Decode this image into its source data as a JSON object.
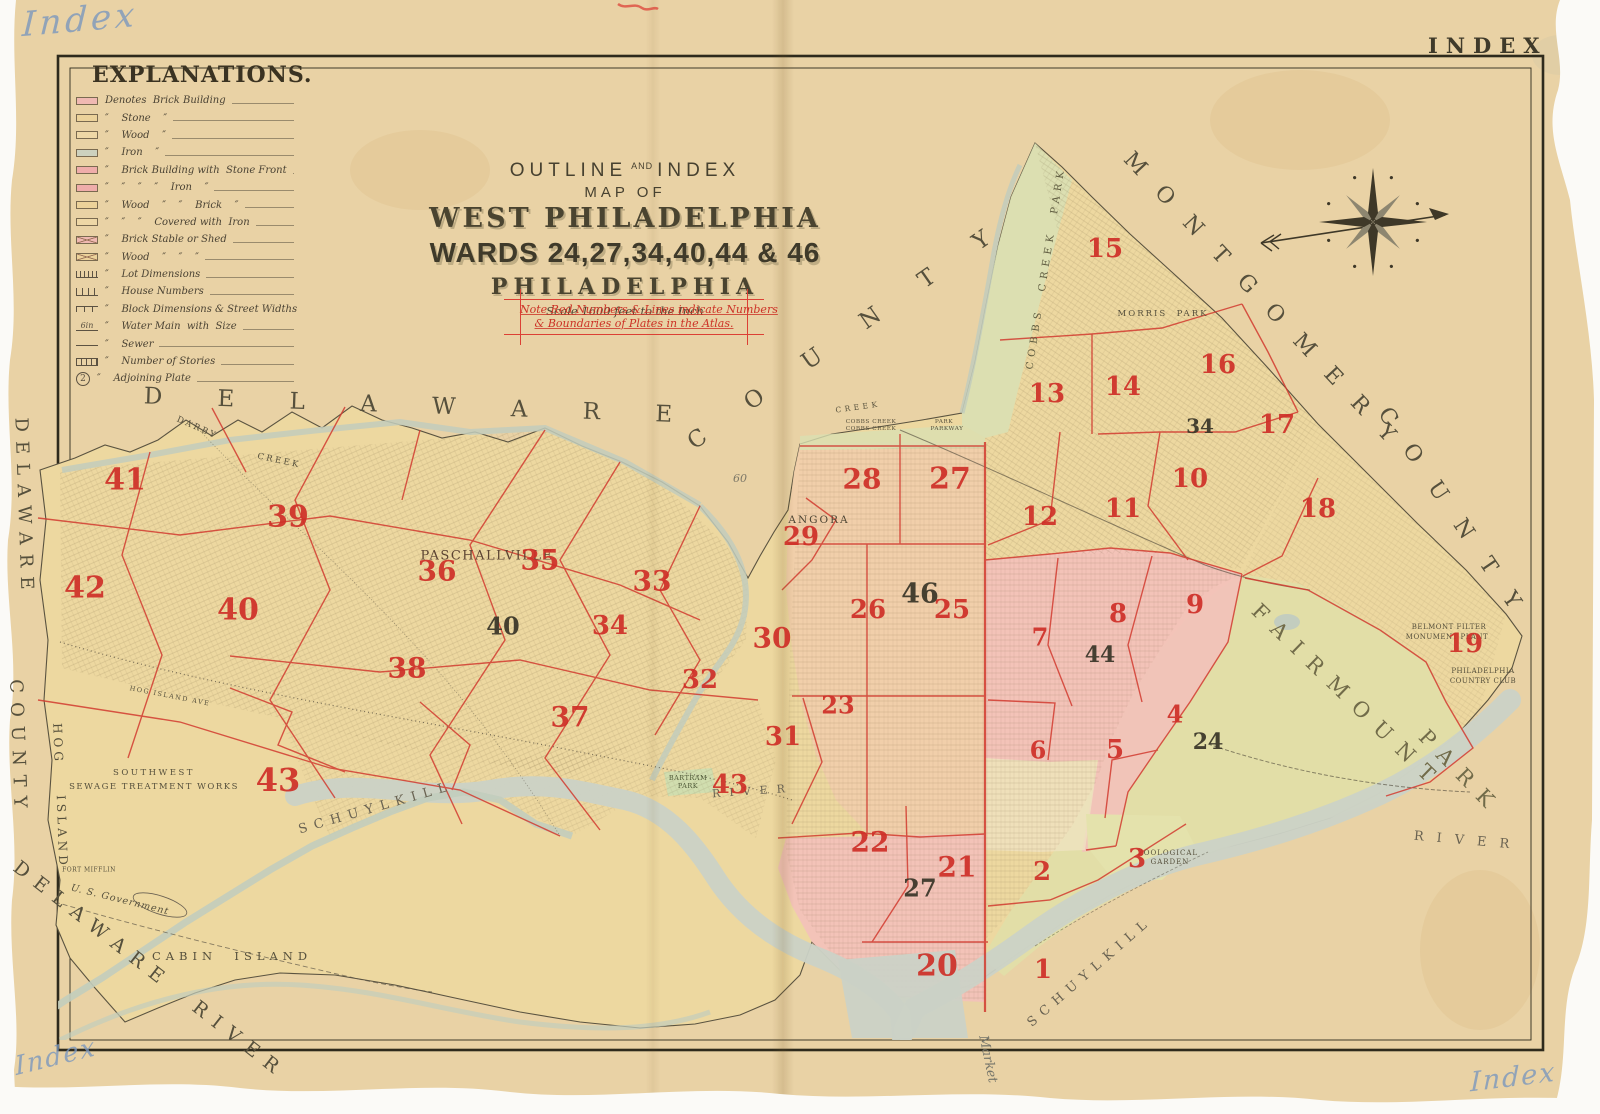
{
  "page": {
    "corner_label": "INDEX",
    "annotations": {
      "top_left": "Index",
      "bottom_left": "Index",
      "bottom_right": "Index",
      "market_note": "Market",
      "pencil_60": "60"
    }
  },
  "legend": {
    "title": "EXPLANATIONS.",
    "items": [
      {
        "swatch": "pink",
        "label": "Denotes  Brick Building"
      },
      {
        "swatch": "tan",
        "label": "″    Stone    ″"
      },
      {
        "swatch": "tan2",
        "label": "″    Wood    ″"
      },
      {
        "swatch": "iron",
        "label": "″    Iron    ″"
      },
      {
        "swatch": "pink2",
        "label": "″    Brick Building with  Stone Front"
      },
      {
        "swatch": "pink2",
        "label": "″    ″    ″    ″    Iron    ″"
      },
      {
        "swatch": "tan",
        "label": "″    Wood    ″    ″    Brick    ″"
      },
      {
        "swatch": "tan2",
        "label": "″    ″    ″    Covered with  Iron"
      },
      {
        "swatch": "xpink",
        "label": "″    Brick Stable or Shed"
      },
      {
        "swatch": "xtan",
        "label": "″    Wood    ″    ″    ″"
      },
      {
        "swatch": "lot",
        "label": "″    Lot Dimensions"
      },
      {
        "swatch": "house",
        "label": "″    House Numbers"
      },
      {
        "swatch": "block",
        "label": "″    Block Dimensions & Street Widths"
      },
      {
        "swatch": "wmain",
        "glyph": "6in",
        "label": "″    Water Main  with  Size"
      },
      {
        "swatch": "sewer",
        "label": "″    Sewer"
      },
      {
        "swatch": "stories",
        "label": "″    Number of Stories"
      },
      {
        "swatch": "circle",
        "glyph": "2",
        "label": "″    Adjoining Plate"
      }
    ]
  },
  "title_block": {
    "line1_left": "OUTLINE",
    "line1_mid": "AND",
    "line1_right": "INDEX",
    "line2": "MAP OF",
    "line3": "WEST PHILADELPHIA",
    "line4": "WARDS 24,27,34,40,44 & 46",
    "line5": "PHILADELPHIA",
    "scale": "Scale 1600 feet to the Inch",
    "note_line1": "Note Red Numbers & Lines indicate Numbers",
    "note_line2": "& Boundaries of Plates in the Atlas."
  },
  "map": {
    "plate_numbers": [
      {
        "n": "41",
        "x": 125,
        "y": 480,
        "s": 30
      },
      {
        "n": "39",
        "x": 288,
        "y": 517,
        "s": 30
      },
      {
        "n": "42",
        "x": 85,
        "y": 588,
        "s": 30
      },
      {
        "n": "40",
        "x": 238,
        "y": 610,
        "s": 30
      },
      {
        "n": "38",
        "x": 407,
        "y": 668,
        "s": 28
      },
      {
        "n": "36",
        "x": 437,
        "y": 571,
        "s": 28
      },
      {
        "n": "35",
        "x": 540,
        "y": 560,
        "s": 28
      },
      {
        "n": "33",
        "x": 652,
        "y": 581,
        "s": 28
      },
      {
        "n": "34",
        "x": 610,
        "y": 626,
        "s": 26
      },
      {
        "n": "30",
        "x": 772,
        "y": 638,
        "s": 28
      },
      {
        "n": "32",
        "x": 700,
        "y": 680,
        "s": 26
      },
      {
        "n": "37",
        "x": 570,
        "y": 717,
        "s": 28
      },
      {
        "n": "31",
        "x": 783,
        "y": 737,
        "s": 26
      },
      {
        "n": "43",
        "x": 730,
        "y": 785,
        "s": 26
      },
      {
        "n": "43",
        "x": 278,
        "y": 780,
        "s": 32
      },
      {
        "n": "23",
        "x": 838,
        "y": 705,
        "s": 24
      },
      {
        "n": "28",
        "x": 862,
        "y": 479,
        "s": 28
      },
      {
        "n": "27",
        "x": 950,
        "y": 479,
        "s": 30
      },
      {
        "n": "29",
        "x": 801,
        "y": 537,
        "s": 26
      },
      {
        "n": "26",
        "x": 868,
        "y": 610,
        "s": 26
      },
      {
        "n": "25",
        "x": 952,
        "y": 610,
        "s": 26
      },
      {
        "n": "12",
        "x": 1040,
        "y": 517,
        "s": 26
      },
      {
        "n": "7",
        "x": 1040,
        "y": 637,
        "s": 24
      },
      {
        "n": "8",
        "x": 1118,
        "y": 614,
        "s": 26
      },
      {
        "n": "9",
        "x": 1195,
        "y": 605,
        "s": 26
      },
      {
        "n": "4",
        "x": 1175,
        "y": 714,
        "s": 24
      },
      {
        "n": "6",
        "x": 1038,
        "y": 750,
        "s": 24
      },
      {
        "n": "5",
        "x": 1115,
        "y": 750,
        "s": 26
      },
      {
        "n": "19",
        "x": 1465,
        "y": 644,
        "s": 26
      },
      {
        "n": "15",
        "x": 1105,
        "y": 249,
        "s": 26
      },
      {
        "n": "16",
        "x": 1218,
        "y": 365,
        "s": 26
      },
      {
        "n": "13",
        "x": 1047,
        "y": 394,
        "s": 26
      },
      {
        "n": "14",
        "x": 1123,
        "y": 387,
        "s": 26
      },
      {
        "n": "17",
        "x": 1277,
        "y": 425,
        "s": 26
      },
      {
        "n": "10",
        "x": 1190,
        "y": 479,
        "s": 26
      },
      {
        "n": "11",
        "x": 1123,
        "y": 509,
        "s": 26
      },
      {
        "n": "18",
        "x": 1318,
        "y": 509,
        "s": 26
      },
      {
        "n": "22",
        "x": 870,
        "y": 842,
        "s": 28
      },
      {
        "n": "21",
        "x": 957,
        "y": 867,
        "s": 28
      },
      {
        "n": "2",
        "x": 1042,
        "y": 872,
        "s": 26
      },
      {
        "n": "3",
        "x": 1137,
        "y": 859,
        "s": 26
      },
      {
        "n": "20",
        "x": 937,
        "y": 966,
        "s": 30
      },
      {
        "n": "1",
        "x": 1043,
        "y": 970,
        "s": 26
      }
    ],
    "ward_numbers": [
      {
        "n": "46",
        "x": 920,
        "y": 594,
        "s": 27
      },
      {
        "n": "40",
        "x": 503,
        "y": 626,
        "s": 24
      },
      {
        "n": "27",
        "x": 920,
        "y": 888,
        "s": 24
      },
      {
        "n": "44",
        "x": 1100,
        "y": 655,
        "s": 22
      },
      {
        "n": "24",
        "x": 1208,
        "y": 742,
        "s": 22
      },
      {
        "n": "34",
        "x": 1200,
        "y": 426,
        "s": 20
      }
    ],
    "labels": [
      {
        "t": "D E L A W A R E",
        "x": 420,
        "y": 406,
        "r": 2,
        "s": 23,
        "ls": 24
      },
      {
        "t": "C O U N T Y",
        "x": 848,
        "y": 334,
        "r": -35,
        "s": 23,
        "ls": 22
      },
      {
        "t": "M O N T G O M E R Y",
        "x": 1262,
        "y": 300,
        "r": 47,
        "s": 22,
        "ls": 8
      },
      {
        "t": "C O U N T Y",
        "x": 1452,
        "y": 512,
        "r": 56,
        "s": 22,
        "ls": 10
      },
      {
        "t": "DELAWARE",
        "x": 24,
        "y": 508,
        "r": 88,
        "s": 18,
        "ls": 9
      },
      {
        "t": "COUNTY",
        "x": 18,
        "y": 748,
        "r": 88,
        "s": 18,
        "ls": 9
      },
      {
        "t": "HOG",
        "x": 58,
        "y": 744,
        "r": 88,
        "s": 12,
        "ls": 4
      },
      {
        "t": "ISLAND",
        "x": 62,
        "y": 832,
        "r": 88,
        "s": 12,
        "ls": 4
      },
      {
        "t": "DELAWARE  RIVER",
        "x": 150,
        "y": 970,
        "r": 38,
        "s": 19,
        "ls": 10
      },
      {
        "t": "SCHUYLKILL",
        "x": 376,
        "y": 808,
        "r": -16,
        "s": 13,
        "ls": 7,
        "c": "#6a6352"
      },
      {
        "t": "RIVER",
        "x": 753,
        "y": 791,
        "r": -4,
        "s": 11,
        "ls": 9,
        "c": "#6a6352"
      },
      {
        "t": "SCHUYLKILL",
        "x": 1090,
        "y": 972,
        "r": -41,
        "s": 13,
        "ls": 7,
        "c": "#6a6352"
      },
      {
        "t": "RIVER",
        "x": 1468,
        "y": 841,
        "r": 5,
        "s": 13,
        "ls": 13,
        "c": "#6a6352"
      },
      {
        "t": "FAIRMOUNT",
        "x": 1348,
        "y": 697,
        "r": 44,
        "s": 21,
        "ls": 13,
        "c": "#716b49"
      },
      {
        "t": "PARK",
        "x": 1461,
        "y": 773,
        "r": 46,
        "s": 21,
        "ls": 13,
        "c": "#716b49"
      },
      {
        "t": "COBBS  CREEK  PARK",
        "x": 1046,
        "y": 268,
        "r": -81,
        "s": 10,
        "ls": 5,
        "c": "#5f5c40"
      },
      {
        "t": "MORRIS  PARK",
        "x": 1163,
        "y": 314,
        "r": 0,
        "s": 8.5,
        "ls": 2
      },
      {
        "t": "ANGORA",
        "x": 819,
        "y": 520,
        "r": 0,
        "s": 10.5,
        "ls": 2,
        "c": "#4c4433"
      },
      {
        "t": "PASCHALLVILLE",
        "x": 487,
        "y": 556,
        "r": 0,
        "s": 13,
        "ls": 1.5,
        "c": "#5b4332"
      },
      {
        "t": "CABIN  ISLAND",
        "x": 232,
        "y": 956,
        "r": 0,
        "s": 11.5,
        "ls": 5
      },
      {
        "t": "SOUTHWEST",
        "x": 154,
        "y": 773,
        "r": 0,
        "s": 8.5,
        "ls": 2.5
      },
      {
        "t": "SEWAGE TREATMENT WORKS",
        "x": 154,
        "y": 787,
        "r": 0,
        "s": 8.5,
        "ls": 1.5
      },
      {
        "t": "ZOOLOGICAL",
        "x": 1168,
        "y": 853,
        "r": 0,
        "s": 7,
        "ls": 1
      },
      {
        "t": "GARDEN",
        "x": 1170,
        "y": 862,
        "r": 0,
        "s": 7,
        "ls": 1
      },
      {
        "t": "BELMONT FILTER",
        "x": 1449,
        "y": 627,
        "r": 0,
        "s": 7,
        "ls": 0.5
      },
      {
        "t": "MONUMENT PLANT",
        "x": 1447,
        "y": 637,
        "r": 0,
        "s": 7,
        "ls": 0.5
      },
      {
        "t": "PHILADELPHIA",
        "x": 1483,
        "y": 671,
        "r": 0,
        "s": 7,
        "ls": 0.5
      },
      {
        "t": "COUNTRY CLUB",
        "x": 1483,
        "y": 681,
        "r": 0,
        "s": 7,
        "ls": 0.5
      },
      {
        "t": "BARTRAM",
        "x": 688,
        "y": 778,
        "r": 0,
        "s": 6.5,
        "ls": 0.5,
        "c": "#4f5a38"
      },
      {
        "t": "PARK",
        "x": 688,
        "y": 786,
        "r": 0,
        "s": 6.5,
        "ls": 0.5,
        "c": "#4f5a38"
      },
      {
        "t": "U. S. Government",
        "x": 120,
        "y": 900,
        "r": 14,
        "s": 9.5,
        "ls": 1,
        "i": true
      },
      {
        "t": "FORT MIFFLIN",
        "x": 89,
        "y": 870,
        "r": 0,
        "s": 6,
        "ls": 0.5
      },
      {
        "t": "DARBY",
        "x": 197,
        "y": 428,
        "r": 24,
        "s": 8.5,
        "ls": 2.5
      },
      {
        "t": "CREEK",
        "x": 279,
        "y": 461,
        "r": 12,
        "s": 8.5,
        "ls": 2.5
      },
      {
        "t": "COBBS CREEK",
        "x": 871,
        "y": 422,
        "r": 0,
        "s": 5.8,
        "ls": 0.5
      },
      {
        "t": "COBBS CREEK",
        "x": 871,
        "y": 429,
        "r": 0,
        "s": 5.8,
        "ls": 0.5
      },
      {
        "t": "PARK",
        "x": 944,
        "y": 422,
        "r": 0,
        "s": 5.8,
        "ls": 0.5
      },
      {
        "t": "PARKWAY",
        "x": 947,
        "y": 429,
        "r": 0,
        "s": 5.8,
        "ls": 0.5
      },
      {
        "t": "CREEK",
        "x": 858,
        "y": 407,
        "r": -8,
        "s": 7.5,
        "ls": 3.5
      },
      {
        "t": "HOG ISLAND AVE",
        "x": 170,
        "y": 696,
        "r": 11,
        "s": 6.5,
        "ls": 1.5
      }
    ]
  },
  "colors": {
    "paper": "#e9d2a5",
    "land_tan": "#edd8a0",
    "district_pink": "#f3c1ba",
    "district_salmon": "#f1ceac",
    "park_green": "#d9e0b2",
    "park_olive": "#e1dea8",
    "water": "#cbd2c6",
    "plate_red": "#cf2f28",
    "ink": "#3e382a",
    "pencil_blue": "#7b98bd"
  }
}
